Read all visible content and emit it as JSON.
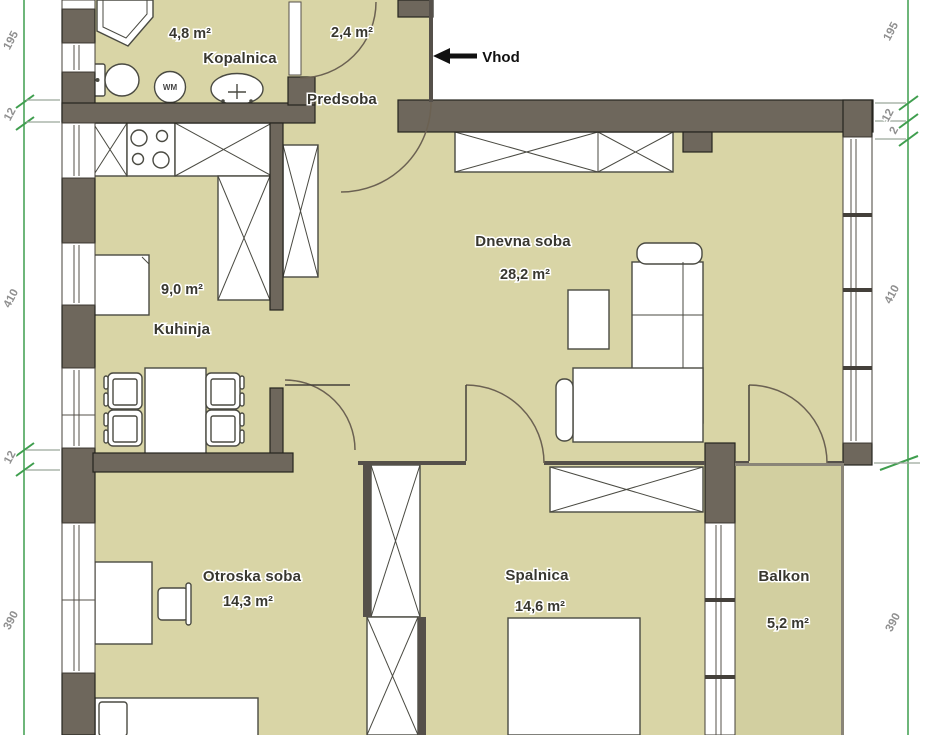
{
  "plan": {
    "entrance_label": "Vhod",
    "washing_machine_label": "WM",
    "rooms": [
      {
        "name": "Kopalnica",
        "area": "4,8 m²"
      },
      {
        "name": "Predsoba",
        "area": "2,4 m²"
      },
      {
        "name": "Dnevna soba",
        "area": "28,2 m²"
      },
      {
        "name": "Kuhinja",
        "area": "9,0 m²"
      },
      {
        "name": "Otroska soba",
        "area": "14,3 m²"
      },
      {
        "name": "Spalnica",
        "area": "14,6 m²"
      },
      {
        "name": "Balkon",
        "area": "5,2 m²"
      }
    ],
    "dimensions": {
      "left": [
        "195",
        "12",
        "410",
        "12",
        "390"
      ],
      "right": [
        "195",
        "12",
        "2",
        "410",
        "390"
      ]
    },
    "colors": {
      "floor": "#d9d5a6",
      "wall": "#6e675c",
      "dimension_line": "#3f9e4e"
    }
  }
}
